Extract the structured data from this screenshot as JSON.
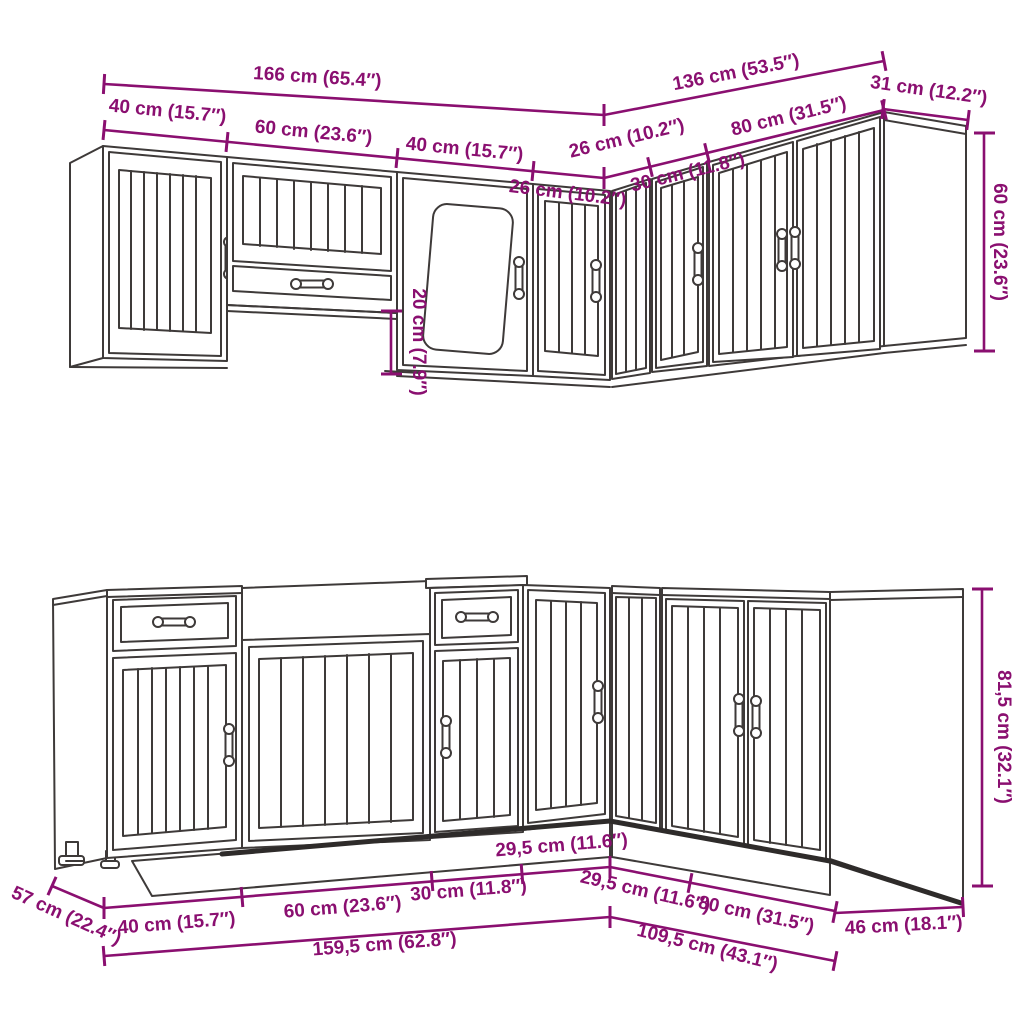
{
  "diagram_type": "kitchen cabinet set dimension drawing",
  "colors": {
    "dimension_annotation": "#8A0F70",
    "line_art": "#3E3A39",
    "background": "#FFFFFF"
  },
  "wall_run": {
    "total_left": "166 cm (65.4″)",
    "total_right": "136 cm (53.5″)",
    "depth_right": "31 cm (12.2″)",
    "cab1_width": "40 cm (15.7″)",
    "cab2_width": "60 cm (23.6″)",
    "cab3_width": "40 cm (15.7″)",
    "cab4_width": "26 cm (10.2″)",
    "cab5_width": "26 cm (10.2″)",
    "cab6_width": "30 cm (11.8″)",
    "cab7_width": "80 cm (31.5″)",
    "height": "60 cm (23.6″)",
    "lift_gap": "20 cm (7.9″)"
  },
  "base_run": {
    "depth_left": "57 cm (22.4″)",
    "cab1_width": "40 cm (15.7″)",
    "cab2_width": "60 cm (23.6″)",
    "cab3_width": "30 cm (11.8″)",
    "cab4_width": "29,5 cm (11.6″)",
    "cab5_width": "29,5 cm (11.6″)",
    "cab6_width": "80 cm (31.5″)",
    "depth_right": "46 cm (18.1″)",
    "total_left": "159,5 cm (62.8″)",
    "total_right": "109,5 cm (43.1″)",
    "height": "81,5 cm (32.1″)"
  }
}
